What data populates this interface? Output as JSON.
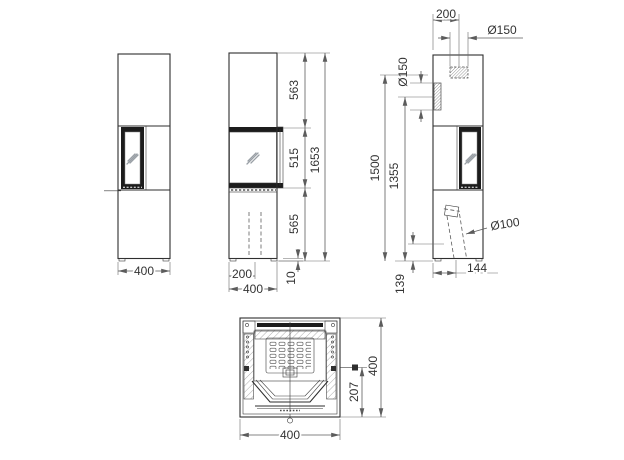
{
  "drawing": {
    "type": "stove-technical-drawing",
    "colors": {
      "line": "#2e2e2e",
      "dimension_line": "#5c5c5c",
      "text": "#333333",
      "background": "#ffffff"
    },
    "dims": {
      "left": {
        "width": "400"
      },
      "front": {
        "upper": "563",
        "door": "515",
        "lower": "565",
        "total": "1653",
        "duct_offset": "200",
        "width": "400",
        "foot": "10"
      },
      "right": {
        "flue_offset": "200",
        "flue_top": "Ø150",
        "flue_rear": "Ø150",
        "top_height": "1500",
        "rear_height": "1355",
        "air_dia": "Ø100",
        "air_offset": "144",
        "air_height": "139"
      },
      "section": {
        "depth": "400",
        "latch": "207",
        "width": "400"
      }
    }
  }
}
